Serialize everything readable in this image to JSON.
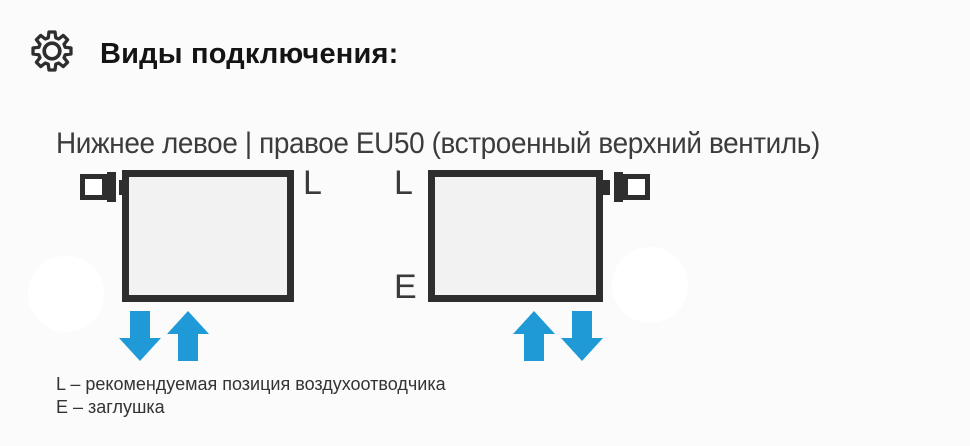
{
  "header": {
    "icon": "gear",
    "title": "Виды подключения:"
  },
  "connection": {
    "subtitle": "Нижнее левое | правое EU50 (встроенный верхний вентиль)",
    "radiator_left": {
      "valve_position": "top-left",
      "label_top_right": "L",
      "arrow_left": "down",
      "arrow_right": "up"
    },
    "radiator_right": {
      "valve_position": "top-right",
      "label_top_left": "L",
      "label_bottom_left": "E",
      "arrow_left": "up",
      "arrow_right": "down"
    },
    "legend": {
      "line1": "L – рекомендуемая позиция воздухоотводчика",
      "line2": "E – заглушка"
    }
  },
  "colors": {
    "accent_blue": "#1f9ad6",
    "outline_dark": "#2e2e2e",
    "radiator_fill": "#f2f2f2",
    "text_dark": "#141414",
    "text_gray": "#3c3c3c"
  }
}
